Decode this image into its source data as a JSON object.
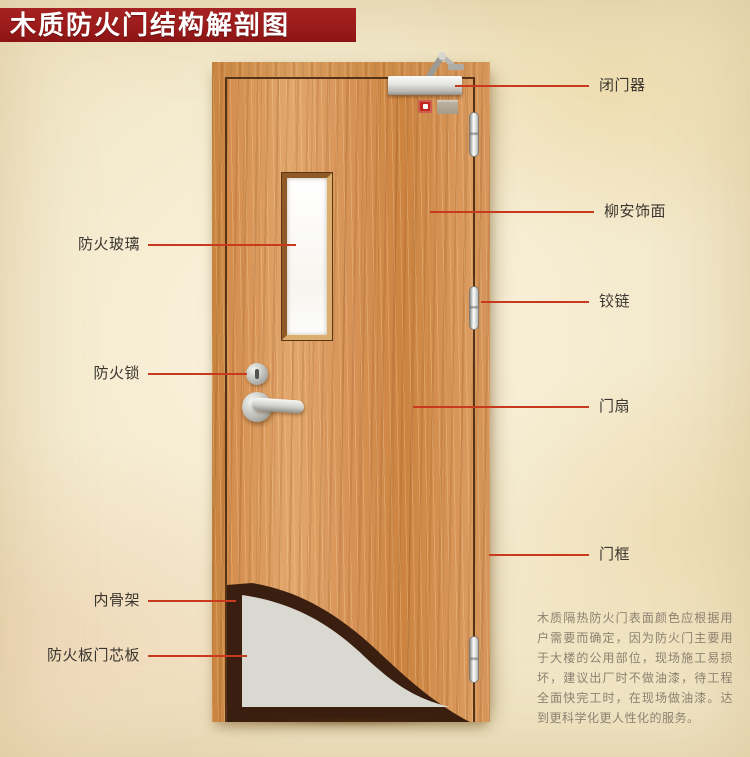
{
  "title_banner": {
    "text": "木质防火门结构解剖图"
  },
  "callouts": {
    "door_closer": {
      "label": "闭门器"
    },
    "veneer": {
      "label": "柳安饰面"
    },
    "hinge": {
      "label": "铰链"
    },
    "door_leaf": {
      "label": "门扇"
    },
    "door_frame": {
      "label": "门框"
    },
    "fire_glass": {
      "label": "防火玻璃"
    },
    "fire_lock": {
      "label": "防火锁"
    },
    "inner_skeleton": {
      "label": "内骨架"
    },
    "fire_board_core": {
      "label": "防火板门芯板"
    }
  },
  "description": {
    "text": "木质隔热防火门表面颜色应根据用户需要而确定，因为防火门主要用于大楼的公用部位，现场施工易损坏，建议出厂时不做油漆，待工程全面快完工时，在现场做油漆。达到更科学化更人性化的服务。"
  },
  "colors": {
    "banner_red": "#9c1b1b",
    "leader_red": "#c8391d",
    "label_text": "#3b362f",
    "note_text": "#8d8171",
    "door_wood": "#d59253",
    "inner_skeleton_dark": "#3a1e0f",
    "core_gray": "#d9d8d1"
  }
}
